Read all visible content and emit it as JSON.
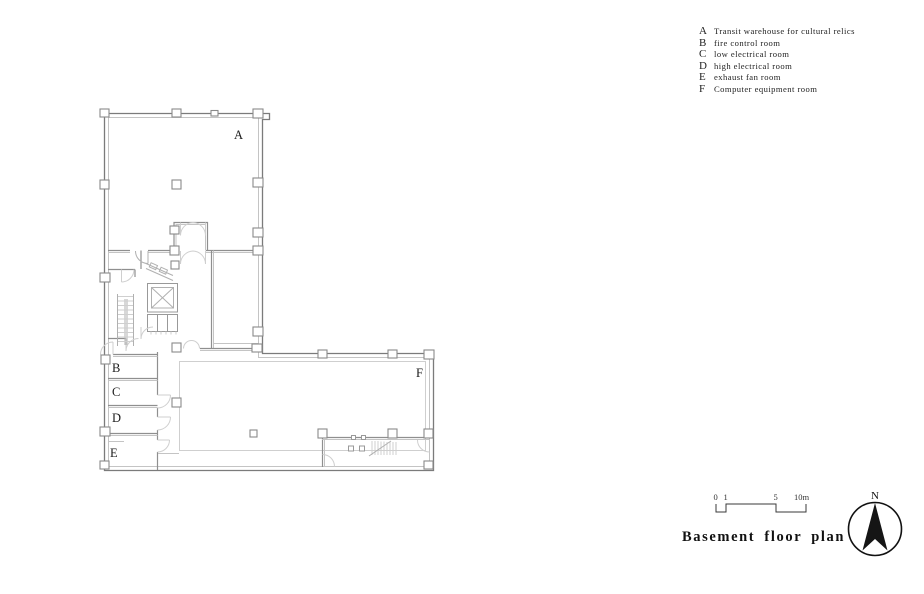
{
  "legend": {
    "items": [
      {
        "letter": "A",
        "label": "Transit warehouse for cultural relics"
      },
      {
        "letter": "B",
        "label": "fire control room"
      },
      {
        "letter": "C",
        "label": "low electrical room"
      },
      {
        "letter": "D",
        "label": "high electrical room"
      },
      {
        "letter": "E",
        "label": "exhaust fan room"
      },
      {
        "letter": "F",
        "label": "Computer equipment room"
      }
    ]
  },
  "plan": {
    "room_labels": [
      {
        "letter": "A"
      },
      {
        "letter": "B"
      },
      {
        "letter": "C"
      },
      {
        "letter": "D"
      },
      {
        "letter": "E"
      },
      {
        "letter": "F"
      }
    ]
  },
  "scalebar": {
    "labels": [
      "0",
      "1",
      "5",
      "10m"
    ]
  },
  "title": "Basement floor plan",
  "north": {
    "label": "N"
  },
  "colors": {
    "wall_dark": "#7b7b7b",
    "wall_light": "#c4c4c4",
    "text": "#1b1b1b",
    "needle": "#151515"
  }
}
